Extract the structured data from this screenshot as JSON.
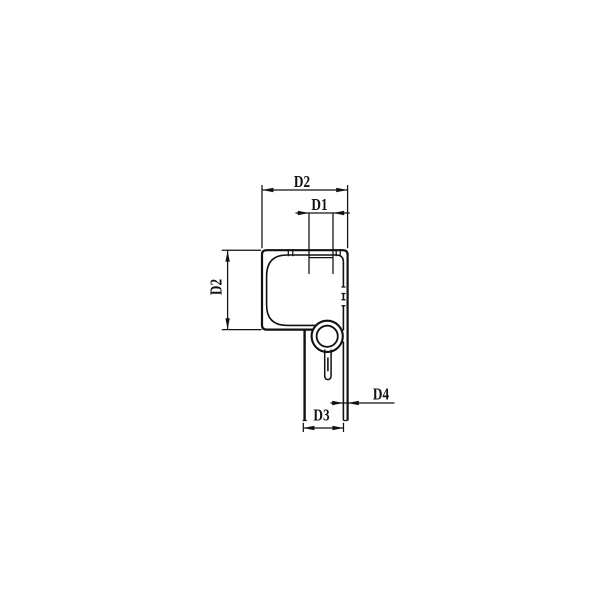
{
  "page": {
    "background_color": "#ffffff",
    "line_color": "#111111"
  },
  "drawing": {
    "type": "technical-cross-section-profile",
    "description": "Dimensioned cross-section of an extruded profile: rounded hollow square body with a screw boss (ring and slotted hole) and an open channel leg below",
    "dimensions": [
      {
        "id": "top-overall-width",
        "label": "D2",
        "orientation": "horizontal"
      },
      {
        "id": "top-groove-width",
        "label": "D1",
        "orientation": "horizontal"
      },
      {
        "id": "left-overall-height",
        "label": "D2",
        "orientation": "vertical"
      },
      {
        "id": "channel-width",
        "label": "D3",
        "orientation": "horizontal"
      },
      {
        "id": "wall-thickness",
        "label": "D4",
        "orientation": "horizontal"
      }
    ]
  }
}
